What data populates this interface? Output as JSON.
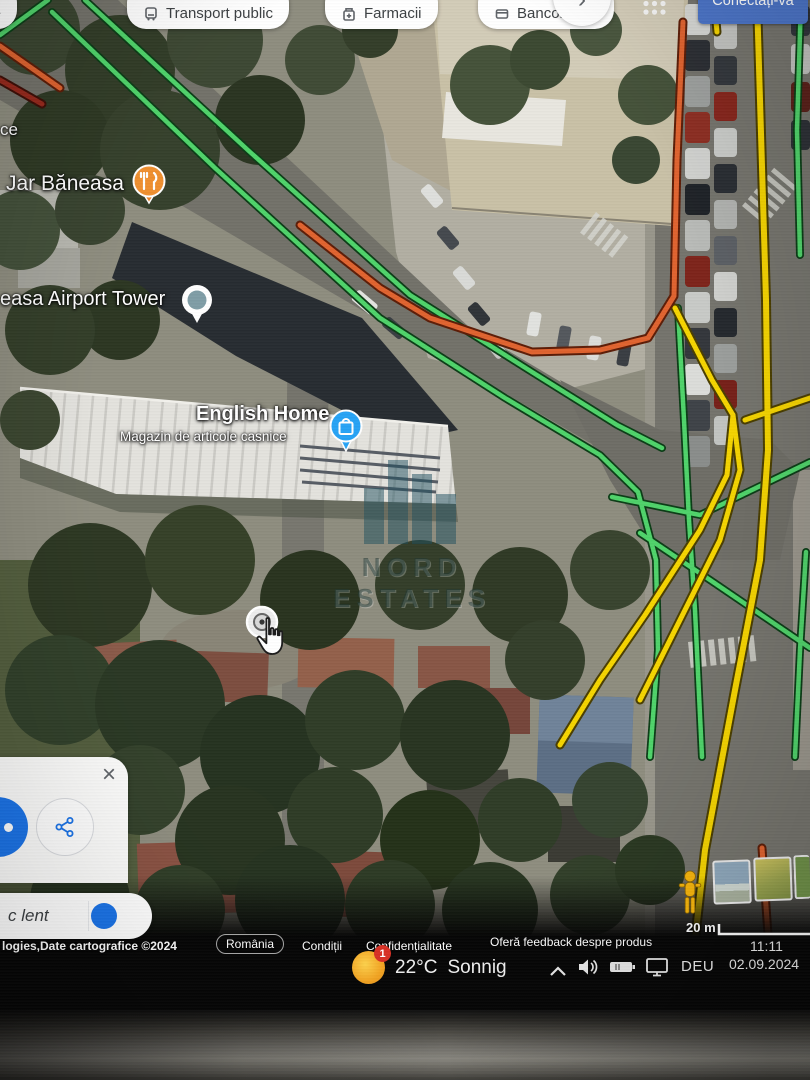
{
  "top_bar": {
    "categories": [
      {
        "label": "Muzee"
      },
      {
        "label": "Transport public"
      },
      {
        "label": "Farmacii"
      },
      {
        "label": "Bancomate"
      }
    ],
    "more_arrow": "›",
    "signin_label": "Conectați-vă",
    "signin_color": "#4b74c8"
  },
  "map": {
    "labels": {
      "fragment": "ce",
      "restaurant": "Jar Băneasa",
      "tower": "easa Airport Tower",
      "store_title": "English Home",
      "store_subtitle": "Magazin de articole casnice"
    },
    "watermark": "NORD ESTATES",
    "traffic_colors": {
      "fast": "#4fd36a",
      "medium": "#f5d400",
      "slow": "#e0632f",
      "very_slow": "#96281b"
    }
  },
  "place_card": {
    "close_label": "×"
  },
  "traffic_pill": {
    "label": "c lent",
    "toggle_color": "#1a73e8"
  },
  "attribution": {
    "copyright": "logies,Date cartografice ©2024",
    "links": [
      "România",
      "Condiții",
      "Confidențialitate",
      "Oferă feedback despre produs"
    ],
    "scale_label": "20 m"
  },
  "taskbar": {
    "weather": {
      "badge": "1",
      "temperature": "22°C",
      "condition": "Sonnig"
    },
    "language": "DEU",
    "time": "11:11",
    "date": "02.09.2024"
  }
}
